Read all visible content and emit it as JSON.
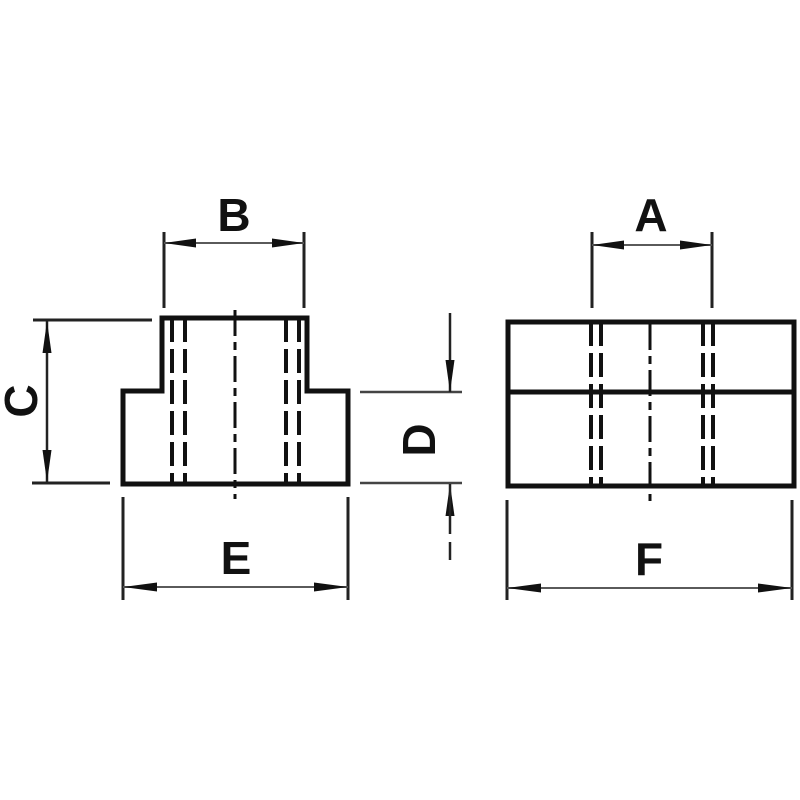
{
  "page": {
    "background": "#ffffff",
    "ink": "#111111",
    "dim_line_color": "#5a5a5a",
    "ext_line_color": "#222222"
  },
  "dimension_labels": {
    "front_width_top": "B",
    "front_height_left": "C",
    "front_width_bottom": "E",
    "side_width_top": "A",
    "side_height_middle": "D",
    "side_width_bottom": "F"
  }
}
